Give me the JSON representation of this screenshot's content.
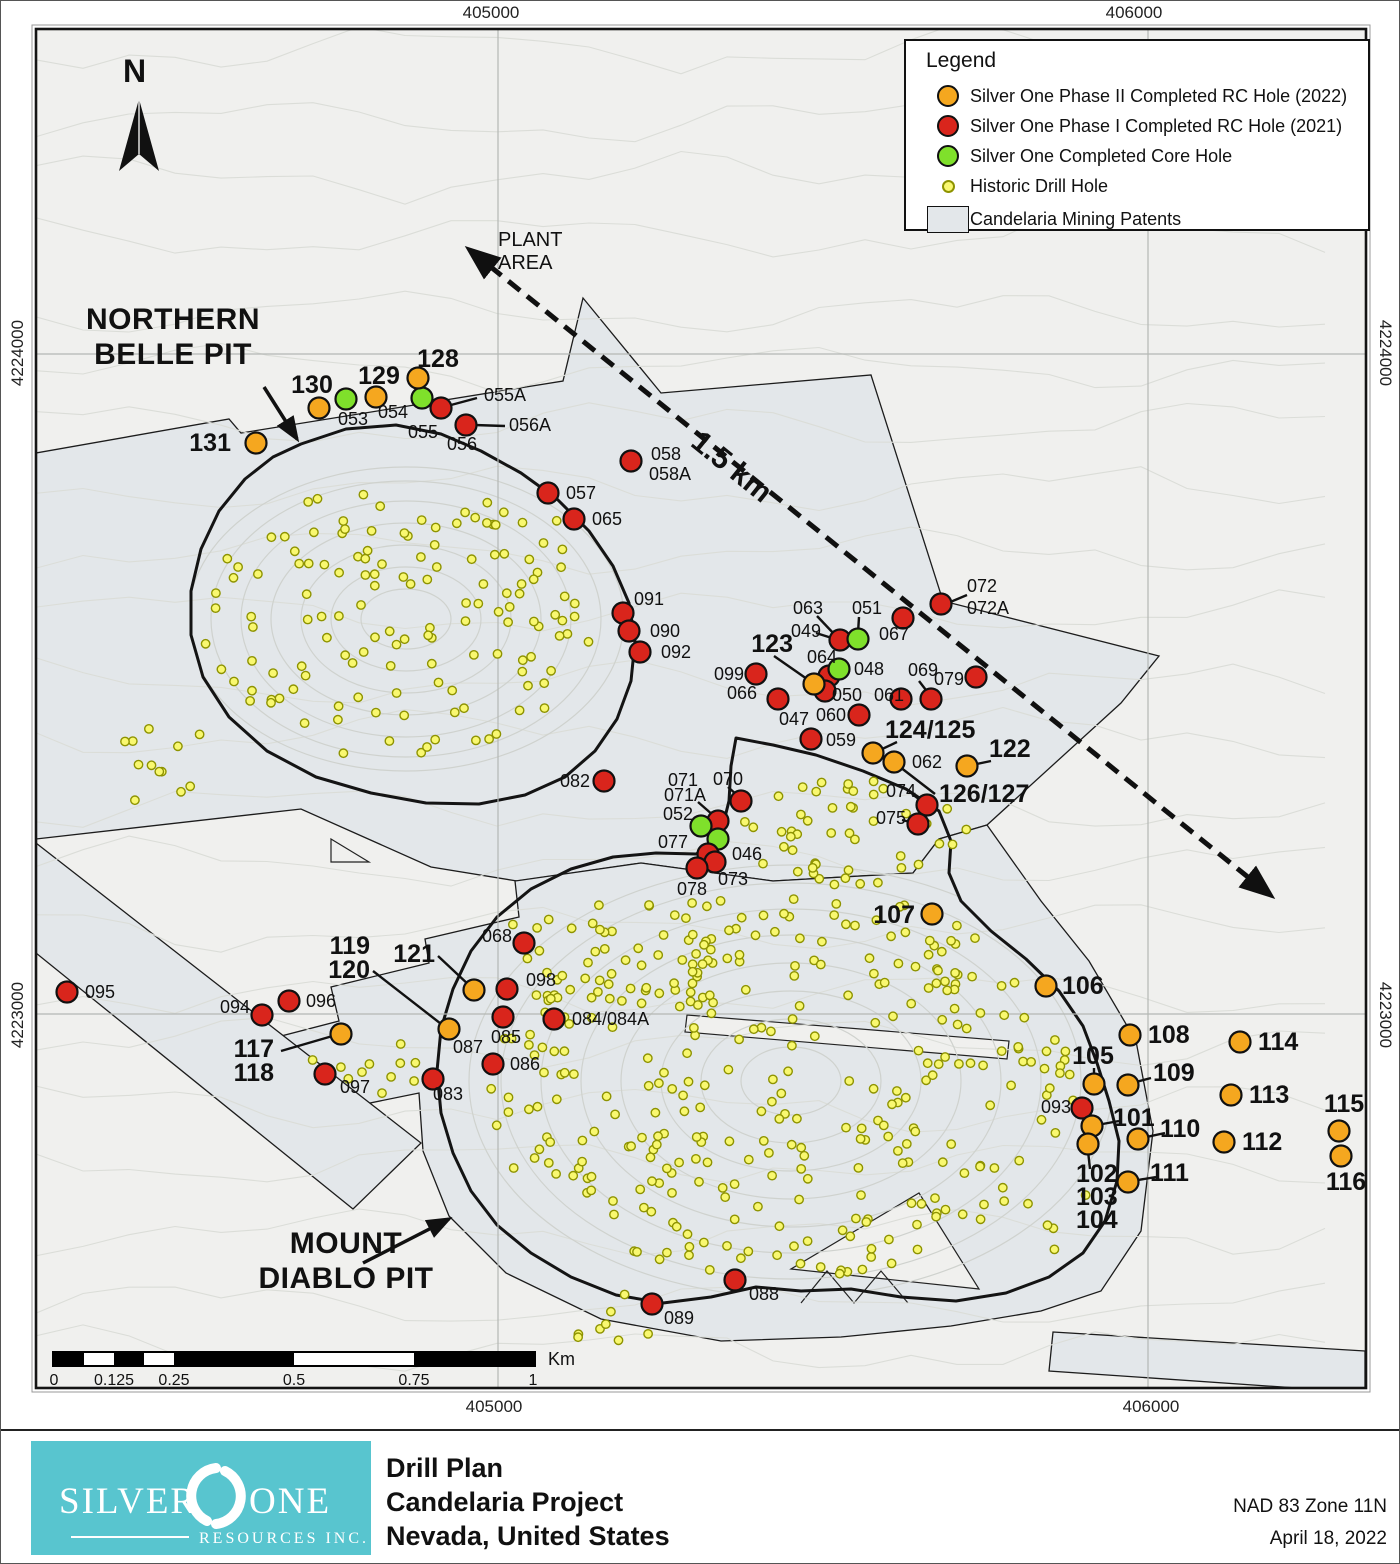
{
  "coordinates": {
    "top_left": "405000",
    "top_right": "406000",
    "bottom_left": "405000",
    "bottom_right": "406000",
    "left_top": "4224000",
    "left_bottom": "4223000",
    "right_top": "4224000",
    "right_bottom": "4223000"
  },
  "legend": {
    "title": "Legend",
    "items": [
      {
        "type": "phase2",
        "label": "Silver One Phase II Completed RC Hole (2022)"
      },
      {
        "type": "phase1",
        "label": "Silver One Phase I Completed RC Hole (2021)"
      },
      {
        "type": "core",
        "label": "Silver One Completed Core Hole"
      },
      {
        "type": "historic",
        "label": "Historic Drill Hole"
      },
      {
        "type": "patent",
        "label": "Candelaria Mining Patents"
      }
    ]
  },
  "annotations": {
    "north": "N",
    "plant_area_line1": "PLANT",
    "plant_area_line2": "AREA",
    "distance": "1.5 km",
    "northern_belle_line1": "NORTHERN",
    "northern_belle_line2": "BELLE PIT",
    "mount_diablo_line1": "MOUNT",
    "mount_diablo_line2": "DIABLO PIT"
  },
  "scalebar": {
    "ticks": [
      "0",
      "0.125",
      "0.25",
      "0.5",
      "0.75",
      "1"
    ],
    "unit": "Km"
  },
  "footer": {
    "title_line1": "Drill Plan",
    "title_line2": "Candelaria Project",
    "title_line3": "Nevada, United States",
    "datum": "NAD 83 Zone 11N",
    "date": "April 18, 2022",
    "logo_word1": "SILVER",
    "logo_word2": "ONE",
    "logo_sub": "RESOURCES INC."
  },
  "map": {
    "colors": {
      "bg": "#f0f0ee",
      "patent": "#e3e7ea",
      "contour": "#dbddd8",
      "pit_contour": "#cfd2ce",
      "grid": "#b4b7b4",
      "outline": "#141414",
      "phase2": "#f5a71f",
      "phase1": "#d9251c",
      "core": "#7fe02b",
      "historic_fill": "#f9f870",
      "historic_stroke": "#8e9300"
    },
    "patents": [
      "35,452 228,418 240,432 562,380 582,297 660,392 870,374 942,600 1158,655 1120,702 986,824 938,838 912,872 772,880 640,862 516,880 430,866 300,808 35,838",
      "230,1048 338,1020 330,986 428,962 424,938 518,916 514,880 640,862 772,880 912,872 938,838 986,824 1040,900 1088,960 1135,1040 1152,1130 1140,1230 1100,1290 1040,1310 950,1325 840,1336 720,1340 600,1318 505,1272 448,1215 422,1150 418,1092 330,1110 262,1130",
      "35,842 420,1142 352,1208 35,952",
      "1052,1331 1364,1350 1364,1387 1296,1387 1048,1370"
    ],
    "claim_slivers": [
      {
        "d": "M790,1268 L978,1288 L918,1192 Z",
        "fill": 1
      },
      {
        "d": "M686,1014 L1008,1040 L1006,1058 L684,1031 Z",
        "fill": 1
      },
      {
        "d": "M800,1302 L826,1270 L853,1302 L880,1270 L907,1302",
        "fill": 0
      },
      {
        "d": "M330,838 L368,861 L330,861 Z",
        "fill": 1
      }
    ],
    "pits": {
      "northern_belle": "300,443 345,428 395,424 440,433 480,450 520,472 556,498 588,530 612,565 628,602 634,640 630,680 616,718 594,750 564,776 524,794 478,803 425,802 370,792 315,776 266,750 228,716 202,676 190,634 190,590 200,548 218,510 244,478 272,456",
      "mount_diablo": "735,737 772,744 815,754 862,770 905,788 938,810 950,840 948,872 960,900 990,930 1025,958 1058,990 1082,1025 1096,1062 1108,1100 1118,1140 1116,1180 1104,1220 1082,1252 1048,1276 1005,1292 955,1300 900,1296 850,1288 800,1290 755,1286 710,1296 662,1302 615,1294 570,1276 530,1252 496,1224 470,1190 452,1152 440,1112 436,1070 440,1028 452,988 470,950 496,916 530,888 570,868 612,856 655,852 695,853 718,840 728,800 730,765"
    },
    "pit_rings": {
      "northern_belle": {
        "cx": 405,
        "cy": 618,
        "r": [
          [
            45,
            30
          ],
          [
            75,
            52
          ],
          [
            105,
            74
          ],
          [
            135,
            96
          ],
          [
            165,
            118
          ],
          [
            195,
            138
          ],
          [
            218,
            152
          ]
        ]
      },
      "mount_diablo": {
        "cx": 790,
        "cy": 1080,
        "r": [
          [
            50,
            34
          ],
          [
            90,
            62
          ],
          [
            130,
            90
          ],
          [
            170,
            118
          ],
          [
            210,
            146
          ],
          [
            250,
            172
          ],
          [
            290,
            198
          ],
          [
            322,
            216
          ]
        ]
      }
    },
    "gridlines": {
      "vertical": [
        497,
        1147
      ],
      "horizontal": [
        353,
        1013
      ]
    },
    "dashed_arrow": [
      470,
      250,
      1268,
      893
    ],
    "pit_arrows": [
      [
        263,
        386,
        296,
        438
      ],
      [
        362,
        1262,
        448,
        1218
      ]
    ],
    "leaders": [
      [
        476,
        397,
        450,
        404
      ],
      [
        504,
        425,
        473,
        424
      ],
      [
        966,
        594,
        947,
        602
      ],
      [
        773,
        655,
        806,
        678
      ],
      [
        816,
        615,
        834,
        634
      ],
      [
        815,
        632,
        834,
        638
      ],
      [
        858,
        616,
        857,
        632
      ],
      [
        918,
        680,
        928,
        693
      ],
      [
        896,
        741,
        877,
        750
      ],
      [
        990,
        760,
        971,
        764
      ],
      [
        899,
        766,
        934,
        793
      ],
      [
        911,
        793,
        922,
        801
      ],
      [
        901,
        819,
        913,
        822
      ],
      [
        727,
        786,
        737,
        795
      ],
      [
        697,
        801,
        713,
        815
      ],
      [
        1093,
        1067,
        1093,
        1078
      ],
      [
        1150,
        1077,
        1131,
        1082
      ],
      [
        1118,
        1120,
        1096,
        1124
      ],
      [
        1164,
        1132,
        1141,
        1137
      ],
      [
        1155,
        1176,
        1131,
        1180
      ],
      [
        1087,
        1150,
        1089,
        1168
      ],
      [
        280,
        1050,
        335,
        1034
      ],
      [
        372,
        970,
        444,
        1026
      ],
      [
        437,
        955,
        470,
        986
      ]
    ],
    "historic_clusters": [
      [
        395,
        622,
        195,
        138,
        130,
        1
      ],
      [
        160,
        765,
        55,
        45,
        12,
        2
      ],
      [
        520,
        545,
        55,
        35,
        10,
        3
      ],
      [
        855,
        832,
        125,
        55,
        48,
        4
      ],
      [
        775,
        1085,
        295,
        193,
        320,
        5
      ],
      [
        905,
        945,
        70,
        55,
        10,
        6
      ],
      [
        1057,
        1160,
        35,
        90,
        9,
        7
      ],
      [
        600,
        950,
        110,
        62,
        28,
        8
      ],
      [
        365,
        1065,
        55,
        42,
        11,
        9
      ],
      [
        600,
        1320,
        80,
        28,
        8,
        10
      ]
    ],
    "dots": [
      [
        "054",
        "g",
        421,
        397
      ],
      [
        "053",
        "g",
        345,
        398
      ],
      [
        "055A",
        "r",
        440,
        407
      ],
      [
        "056A",
        "r",
        465,
        424
      ],
      [
        "128",
        "o",
        417,
        377
      ],
      [
        "129",
        "o",
        375,
        396
      ],
      [
        "130",
        "o",
        318,
        407
      ],
      [
        "131",
        "o",
        255,
        442
      ],
      [
        "058",
        "r",
        630,
        460
      ],
      [
        "057",
        "r",
        547,
        492
      ],
      [
        "065",
        "r",
        573,
        518
      ],
      [
        "091",
        "r",
        622,
        612
      ],
      [
        "090",
        "r",
        628,
        630
      ],
      [
        "092",
        "r",
        639,
        651
      ],
      [
        "072",
        "r",
        940,
        603
      ],
      [
        "067",
        "r",
        902,
        617
      ],
      [
        "049",
        "r",
        839,
        639
      ],
      [
        "051",
        "g",
        857,
        638
      ],
      [
        "064",
        "r",
        828,
        675
      ],
      [
        "048",
        "g",
        838,
        668
      ],
      [
        "050",
        "r",
        824,
        690
      ],
      [
        "123",
        "o",
        813,
        683
      ],
      [
        "099",
        "r",
        755,
        673
      ],
      [
        "066",
        "r",
        777,
        698
      ],
      [
        "061",
        "r",
        900,
        698
      ],
      [
        "069",
        "r",
        930,
        698
      ],
      [
        "079",
        "r",
        975,
        676
      ],
      [
        "060",
        "r",
        858,
        714
      ],
      [
        "059",
        "r",
        810,
        738
      ],
      [
        "124/125",
        "o",
        872,
        752
      ],
      [
        "062",
        "o",
        893,
        761
      ],
      [
        "122",
        "o",
        966,
        765
      ],
      [
        "074",
        "r",
        926,
        804
      ],
      [
        "075",
        "r",
        917,
        823
      ],
      [
        "082",
        "r",
        603,
        780
      ],
      [
        "070",
        "r",
        740,
        800
      ],
      [
        "071",
        "r",
        717,
        820
      ],
      [
        "052",
        "g",
        700,
        825
      ],
      [
        "046",
        "g",
        717,
        838
      ],
      [
        "077",
        "r",
        707,
        853
      ],
      [
        "073",
        "r",
        714,
        861
      ],
      [
        "078",
        "r",
        696,
        867
      ],
      [
        "107",
        "o",
        931,
        913
      ],
      [
        "106",
        "o",
        1045,
        985
      ],
      [
        "095",
        "r",
        66,
        991
      ],
      [
        "096",
        "r",
        288,
        1000
      ],
      [
        "094",
        "r",
        261,
        1014
      ],
      [
        "117/118",
        "o",
        340,
        1033
      ],
      [
        "097",
        "r",
        324,
        1073
      ],
      [
        "068",
        "r",
        523,
        942
      ],
      [
        "121",
        "o",
        473,
        989
      ],
      [
        "098",
        "r",
        506,
        988
      ],
      [
        "085",
        "r",
        502,
        1016
      ],
      [
        "084",
        "r",
        553,
        1018
      ],
      [
        "119/120",
        "o",
        448,
        1028
      ],
      [
        "086",
        "r",
        492,
        1063
      ],
      [
        "083",
        "r",
        432,
        1078
      ],
      [
        "108",
        "o",
        1129,
        1034
      ],
      [
        "114",
        "o",
        1239,
        1041
      ],
      [
        "105",
        "o",
        1093,
        1083
      ],
      [
        "109",
        "o",
        1127,
        1084
      ],
      [
        "113",
        "o",
        1230,
        1094
      ],
      [
        "093",
        "r",
        1081,
        1107
      ],
      [
        "101",
        "o",
        1091,
        1125
      ],
      [
        "110",
        "o",
        1137,
        1138
      ],
      [
        "112",
        "o",
        1223,
        1141
      ],
      [
        "115",
        "o",
        1338,
        1130
      ],
      [
        "116",
        "o",
        1340,
        1155
      ],
      [
        "102/103/104",
        "o",
        1087,
        1143
      ],
      [
        "111",
        "o",
        1127,
        1181
      ],
      [
        "088",
        "r",
        734,
        1279
      ],
      [
        "089",
        "r",
        651,
        1303
      ]
    ],
    "labels": [
      [
        "128",
        437,
        366,
        "m",
        1
      ],
      [
        "129",
        378,
        383,
        "m",
        1
      ],
      [
        "130",
        311,
        392,
        "m",
        1
      ],
      [
        "131",
        230,
        450,
        "e",
        1
      ],
      [
        "053",
        352,
        424,
        "m",
        0
      ],
      [
        "054",
        407,
        417,
        "e",
        0
      ],
      [
        "055",
        437,
        437,
        "e",
        0
      ],
      [
        "055A",
        483,
        400,
        "s",
        0
      ],
      [
        "056",
        461,
        449,
        "m",
        0
      ],
      [
        "056A",
        508,
        430,
        "s",
        0
      ],
      [
        "058",
        650,
        459,
        "s",
        0
      ],
      [
        "058A",
        648,
        479,
        "s",
        0
      ],
      [
        "057",
        565,
        498,
        "s",
        0
      ],
      [
        "065",
        591,
        524,
        "s",
        0
      ],
      [
        "091",
        633,
        604,
        "s",
        0
      ],
      [
        "090",
        649,
        636,
        "s",
        0
      ],
      [
        "092",
        660,
        657,
        "s",
        0
      ],
      [
        "063",
        822,
        613,
        "e",
        0
      ],
      [
        "049",
        820,
        636,
        "e",
        0
      ],
      [
        "051",
        866,
        613,
        "m",
        0
      ],
      [
        "067",
        878,
        639,
        "s",
        0
      ],
      [
        "072",
        966,
        591,
        "s",
        0
      ],
      [
        "072A",
        966,
        613,
        "s",
        0
      ],
      [
        "123",
        792,
        651,
        "e",
        1
      ],
      [
        "064",
        821,
        662,
        "m",
        0
      ],
      [
        "048",
        853,
        674,
        "s",
        0
      ],
      [
        "099",
        743,
        679,
        "e",
        0
      ],
      [
        "066",
        756,
        698,
        "e",
        0
      ],
      [
        "047",
        793,
        724,
        "m",
        0
      ],
      [
        "050",
        831,
        700,
        "s",
        0
      ],
      [
        "061",
        873,
        700,
        "s",
        0
      ],
      [
        "060",
        845,
        720,
        "e",
        0
      ],
      [
        "069",
        922,
        675,
        "m",
        0
      ],
      [
        "079",
        963,
        684,
        "e",
        0
      ],
      [
        "059",
        825,
        745,
        "s",
        0
      ],
      [
        "124/125",
        884,
        737,
        "s",
        1
      ],
      [
        "062",
        911,
        767,
        "s",
        0
      ],
      [
        "122",
        988,
        756,
        "s",
        1
      ],
      [
        "126/127",
        938,
        801,
        "s",
        1
      ],
      [
        "074",
        915,
        796,
        "e",
        0
      ],
      [
        "075",
        905,
        823,
        "e",
        0
      ],
      [
        "082",
        589,
        786,
        "e",
        0
      ],
      [
        "070",
        712,
        784,
        "s",
        0
      ],
      [
        "071",
        667,
        785,
        "s",
        0
      ],
      [
        "071A",
        663,
        800,
        "s",
        0
      ],
      [
        "052",
        692,
        819,
        "e",
        0
      ],
      [
        "046",
        731,
        859,
        "s",
        0
      ],
      [
        "077",
        687,
        847,
        "e",
        0
      ],
      [
        "073",
        717,
        884,
        "s",
        0
      ],
      [
        "078",
        676,
        894,
        "s",
        0
      ],
      [
        "107",
        914,
        922,
        "e",
        1
      ],
      [
        "106",
        1061,
        993,
        "s",
        1
      ],
      [
        "095",
        84,
        997,
        "s",
        0
      ],
      [
        "094",
        249,
        1012,
        "e",
        0
      ],
      [
        "096",
        305,
        1006,
        "s",
        0
      ],
      [
        "117",
        273,
        1056,
        "e",
        1
      ],
      [
        "118",
        273,
        1080,
        "e",
        1
      ],
      [
        "097",
        339,
        1092,
        "s",
        0
      ],
      [
        "119",
        369,
        953,
        "e",
        1
      ],
      [
        "120",
        369,
        977,
        "e",
        1
      ],
      [
        "121",
        434,
        961,
        "e",
        1
      ],
      [
        "068",
        511,
        941,
        "e",
        0
      ],
      [
        "098",
        525,
        985,
        "s",
        0
      ],
      [
        "087",
        452,
        1052,
        "s",
        0
      ],
      [
        "085",
        505,
        1042,
        "m",
        0
      ],
      [
        "084/084A",
        571,
        1024,
        "s",
        0
      ],
      [
        "086",
        509,
        1069,
        "s",
        0
      ],
      [
        "083",
        447,
        1099,
        "m",
        0
      ],
      [
        "108",
        1147,
        1042,
        "s",
        1
      ],
      [
        "114",
        1257,
        1049,
        "s",
        1
      ],
      [
        "105",
        1092,
        1063,
        "m",
        1
      ],
      [
        "109",
        1152,
        1080,
        "s",
        1
      ],
      [
        "113",
        1248,
        1102,
        "s",
        1
      ],
      [
        "093",
        1070,
        1112,
        "e",
        0
      ],
      [
        "101",
        1112,
        1125,
        "s",
        1
      ],
      [
        "110",
        1159,
        1136,
        "s",
        1
      ],
      [
        "112",
        1241,
        1149,
        "s",
        1
      ],
      [
        "115",
        1343,
        1111,
        "m",
        1
      ],
      [
        "116",
        1345,
        1189,
        "m",
        1
      ],
      [
        "111",
        1149,
        1180,
        "s",
        1
      ],
      [
        "102",
        1075,
        1181,
        "s",
        1
      ],
      [
        "103",
        1075,
        1204,
        "s",
        1
      ],
      [
        "104",
        1075,
        1227,
        "s",
        1
      ],
      [
        "088",
        748,
        1299,
        "s",
        0
      ],
      [
        "089",
        663,
        1323,
        "s",
        0
      ]
    ]
  }
}
